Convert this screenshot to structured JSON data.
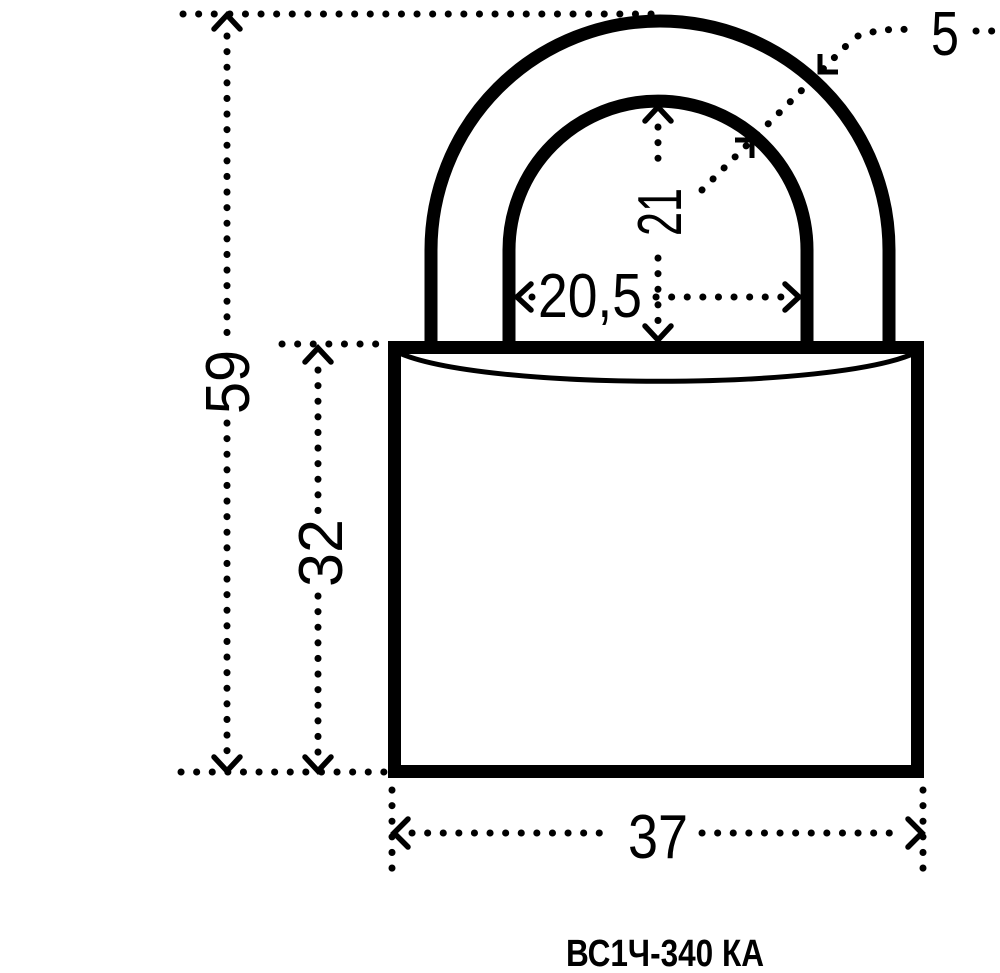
{
  "colors": {
    "ink": "#000000",
    "background": "#ffffff"
  },
  "labels": {
    "total_height": "59",
    "body_height": "32",
    "shackle_inner_height": "21",
    "shackle_inner_width": "20,5",
    "body_width": "37",
    "shackle_diameter": "5",
    "model": "ВС1Ч-340 КА"
  }
}
